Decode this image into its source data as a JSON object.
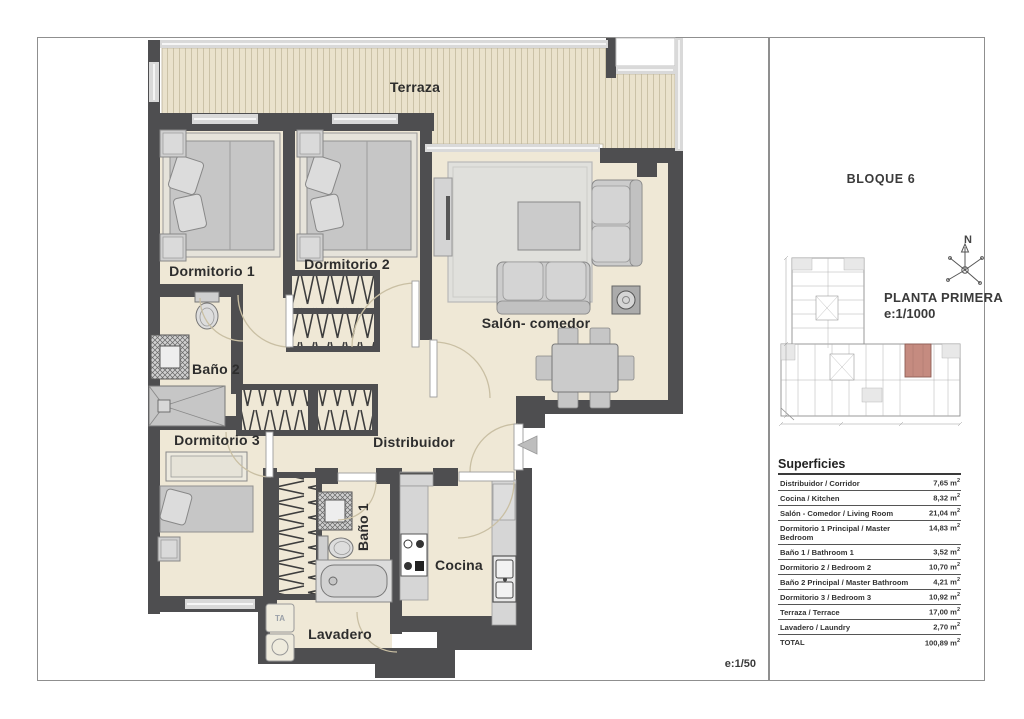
{
  "page": {
    "scale_label": "e:1/50"
  },
  "side_panel": {
    "block_title": "BLOQUE 6",
    "floor_title": "PLANTA PRIMERA",
    "floor_scale": "e:1/1000",
    "compass_north": "N"
  },
  "rooms": {
    "terraza": "Terraza",
    "dormitorio1": "Dormitorio 1",
    "dormitorio2": "Dormitorio 2",
    "salon": "Salón- comedor",
    "bano2": "Baño 2",
    "dormitorio3": "Dormitorio 3",
    "distribuidor": "Distribuidor",
    "bano1": "Baño 1",
    "cocina": "Cocina",
    "lavadero": "Lavadero"
  },
  "fixtures": {
    "washer_label": "TA"
  },
  "surfaces": {
    "title": "Superficies",
    "unit_base": "m",
    "unit_sup": "2",
    "rows": [
      {
        "label": "Distribuidor / Corridor",
        "value": "7,65"
      },
      {
        "label": "Cocina / Kitchen",
        "value": "8,32"
      },
      {
        "label": "Salón - Comedor / Living Room",
        "value": "21,04"
      },
      {
        "label": "Dormitorio 1 Principal / Master Bedroom",
        "value": "14,83"
      },
      {
        "label": "Baño 1 / Bathroom 1",
        "value": "3,52"
      },
      {
        "label": "Dormitorio 2 / Bedroom 2",
        "value": "10,70"
      },
      {
        "label": "Baño 2 Principal / Master Bathroom",
        "value": "4,21"
      },
      {
        "label": "Dormitorio 3 / Bedroom 3",
        "value": "10,92"
      },
      {
        "label": "Terraza / Terrace",
        "value": "17,00"
      },
      {
        "label": "Lavadero / Laundry",
        "value": "2,70"
      },
      {
        "label": "TOTAL",
        "value": "100,89"
      }
    ]
  },
  "colors": {
    "wall": "#4e4e50",
    "floor": "#efe8d6",
    "highlight_unit": "#c58b80"
  }
}
